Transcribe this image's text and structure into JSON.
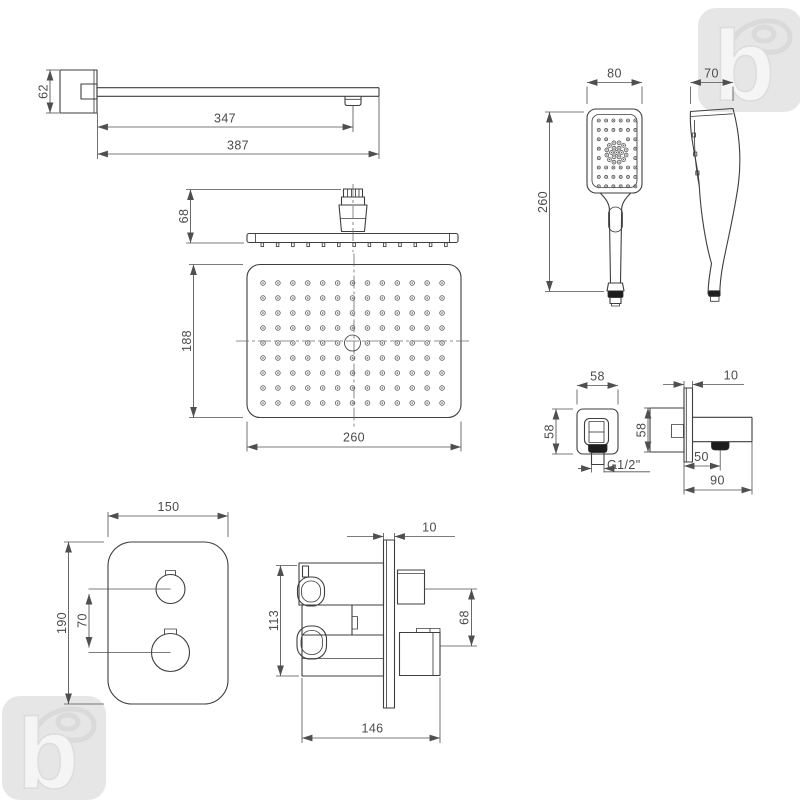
{
  "drawing_title": "shower-set-technical-dimensions",
  "dims": {
    "arm": {
      "height": "62",
      "to_nozzle": "347",
      "total": "387"
    },
    "head_side": {
      "height": "68"
    },
    "head_plan": {
      "depth": "188",
      "width": "260"
    },
    "hand": {
      "width": "80",
      "depth": "70",
      "length": "260"
    },
    "elbow": {
      "width": "58",
      "height": "58",
      "plate": "10",
      "side_height": "58",
      "offset": "50",
      "projection": "90",
      "thread": "G1/2\""
    },
    "mixer": {
      "width": "150",
      "height": "190",
      "spacing": "70",
      "plate": "10",
      "body": "113",
      "outlets": "68",
      "depth": "146"
    }
  },
  "watermark": {
    "letter": "b"
  },
  "colors": {
    "line": "#3e3e3e",
    "dim_text": "#4b4b4b",
    "dark_fill": "#1d1d1d",
    "watermark": "#e6e6e6"
  }
}
